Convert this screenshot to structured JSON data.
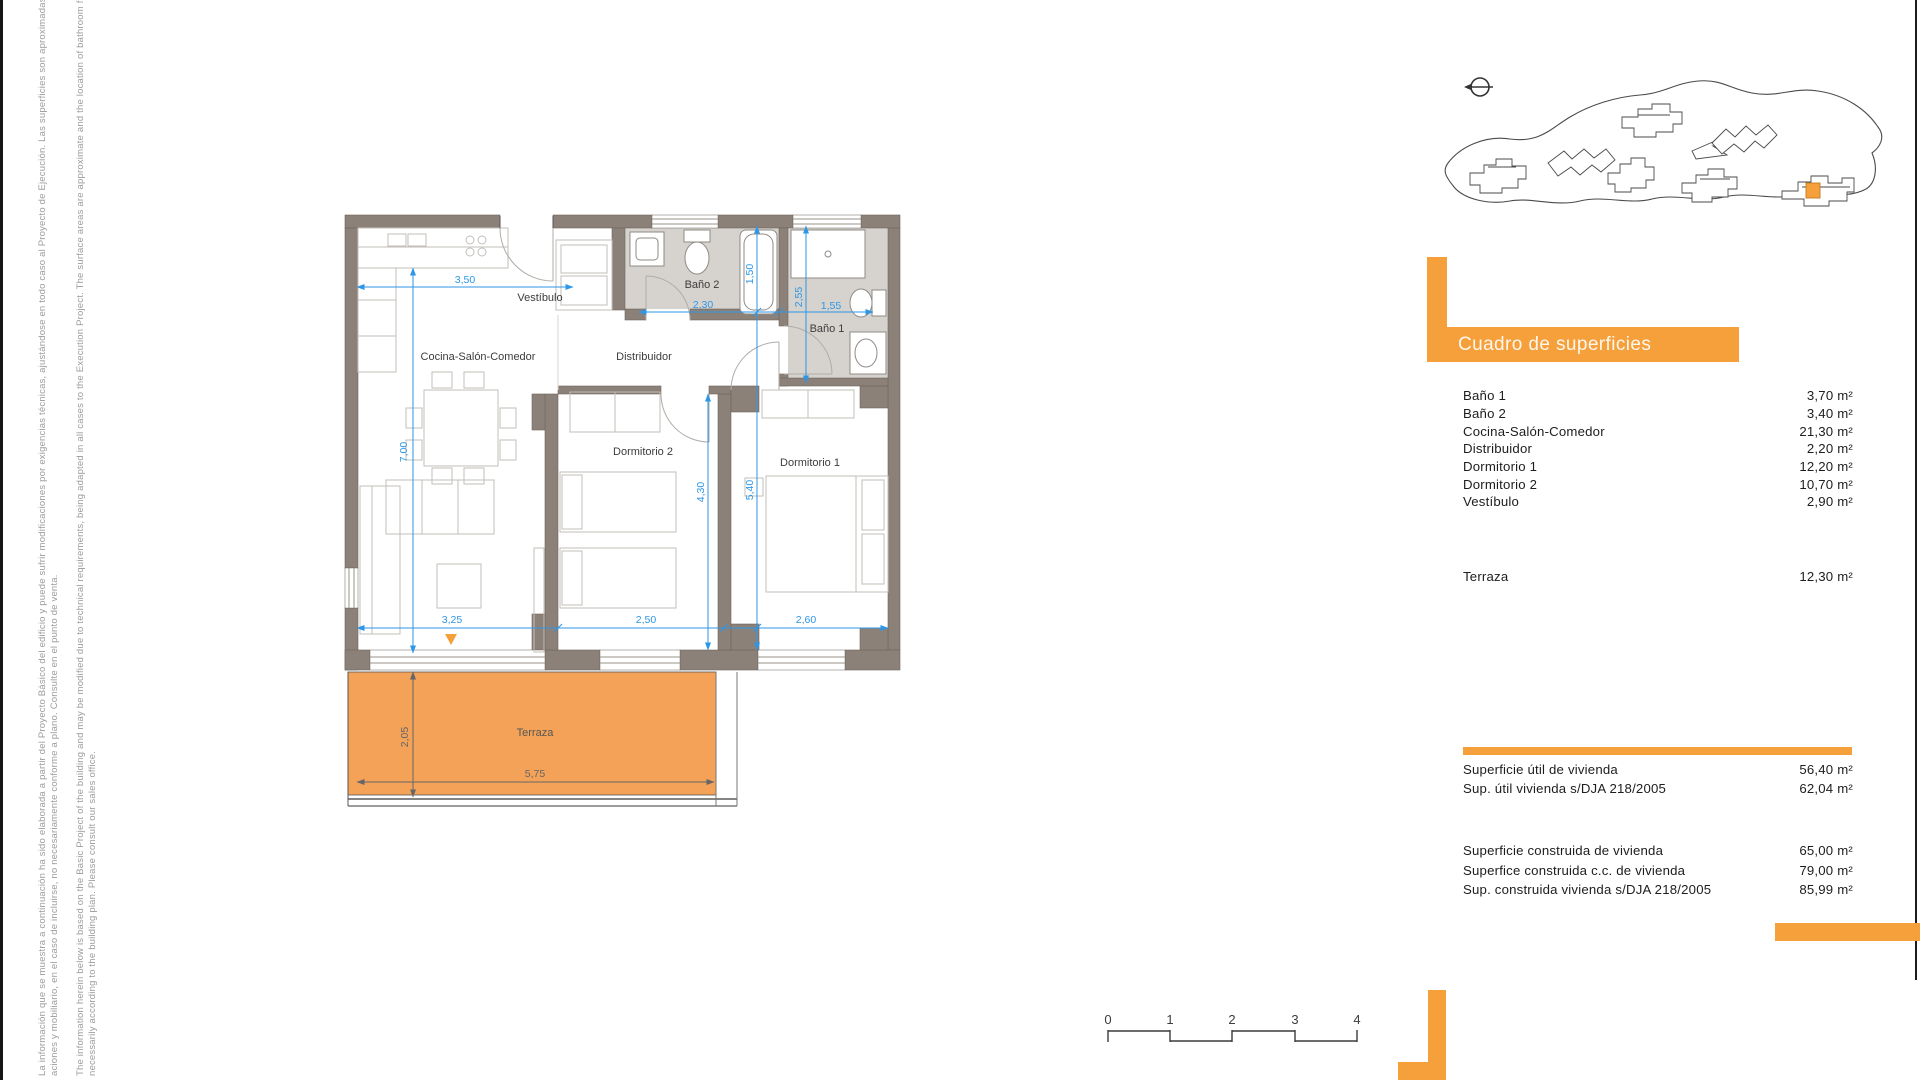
{
  "disclaimer": {
    "es_line1": "La información que se muestra a continuación ha sido elaborada a partir del Proyecto Básico del edificio y puede sufrir modificaciones por exigencias técnicas, ajustándose en todo caso al Proyecto de Ejecución. Las superficies son aproximadas y la ubica",
    "es_line2": "aciones y mobiliario, en el caso de incluirse, no necesariamente conforme a plano. Consulte en el punto de venta.",
    "en_line1": "The information herein below is based on the Basic Project of the building and may be modified due to technical requirements, being adapted in all cases to the Execution Project. The surface areas are approximate and the location of bathroom fittings, facilities",
    "en_line2": "necessarily according to the building plan. Please consult our sales office."
  },
  "plan": {
    "rooms": {
      "vestibulo": "Vestíbulo",
      "cocina": "Cocina-Salón-Comedor",
      "distribuidor": "Distribuidor",
      "bano2": "Baño 2",
      "bano1": "Baño 1",
      "dorm2": "Dormitorio 2",
      "dorm1": "Dormitorio 1",
      "terraza": "Terraza"
    },
    "dims": {
      "w350": "3,50",
      "h700": "7,00",
      "w230": "2,30",
      "h150": "1,50",
      "h255": "2,55",
      "w155": "1,55",
      "h540": "5,40",
      "h430": "4,30",
      "w325": "3,25",
      "w250": "2,50",
      "w260": "2,60",
      "t205": "2,05",
      "t575": "5,75"
    }
  },
  "surfaces_table": {
    "title": "Cuadro de superficies",
    "rows": [
      {
        "label": "Baño 1",
        "value": "3,70 m²"
      },
      {
        "label": "Baño 2",
        "value": "3,40 m²"
      },
      {
        "label": "Cocina-Salón-Comedor",
        "value": "21,30 m²"
      },
      {
        "label": "Distribuidor",
        "value": "2,20 m²"
      },
      {
        "label": "Dormitorio 1",
        "value": "12,20 m²"
      },
      {
        "label": "Dormitorio 2",
        "value": "10,70 m²"
      },
      {
        "label": "Vestíbulo",
        "value": "2,90 m²"
      }
    ],
    "terrace_row": {
      "label": "Terraza",
      "value": "12,30 m²"
    },
    "useful_rows": [
      {
        "label": "Superficie útil de vivienda",
        "value": "56,40 m²"
      },
      {
        "label": "Sup. útil vivienda s/DJA 218/2005",
        "value": "62,04 m²"
      }
    ],
    "built_rows": [
      {
        "label": "Superficie construida de vivienda",
        "value": "65,00 m²"
      },
      {
        "label": "Superfice construida c.c. de vivienda",
        "value": "79,00 m²"
      },
      {
        "label": "Sup. construida vivienda s/DJA 218/2005",
        "value": "85,99 m²"
      }
    ]
  },
  "scalebar": {
    "labels": [
      "0",
      "1",
      "2",
      "3",
      "4"
    ]
  },
  "colors": {
    "accent_orange": "#f6a03c",
    "terrace_orange": "#f3a258",
    "wall_taupe": "#8c8178",
    "bath_floor": "#d6d3cf",
    "dimension_blue": "#2d96e6"
  }
}
